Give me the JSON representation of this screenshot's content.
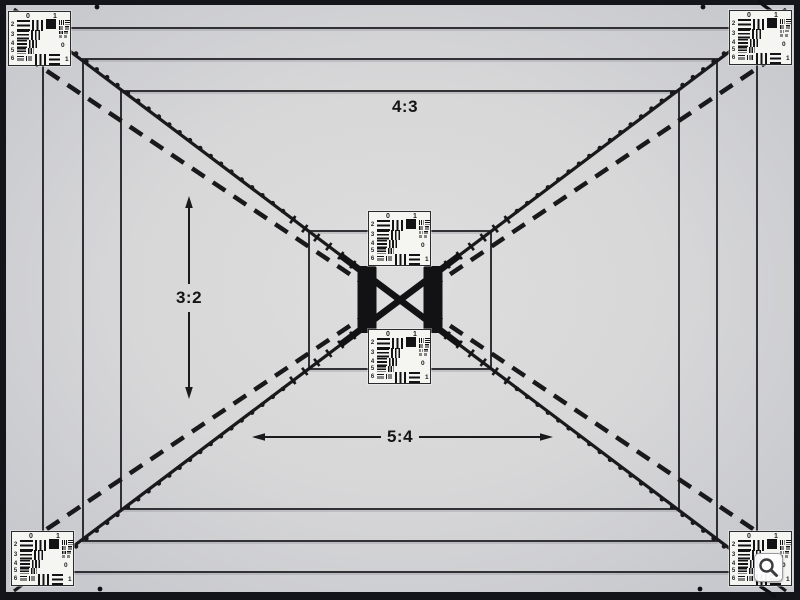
{
  "page": {
    "title": "Viewfinder accuracy test chart photograph"
  },
  "labels": {
    "aspect_4_3": "4:3",
    "aspect_3_2": "3:2",
    "aspect_5_4": "5:4"
  },
  "usaf": {
    "top_digits": [
      "0",
      "1"
    ],
    "left_digits": [
      "2",
      "3",
      "4",
      "5",
      "6"
    ],
    "right_digits": [
      "0",
      "1"
    ]
  },
  "chart_elements": {
    "aspect_rectangles": [
      "outer",
      "middle",
      "inner-4:3",
      "center-box"
    ],
    "diagonal_styles": [
      "solid",
      "dashed",
      "dotted"
    ],
    "resolution_targets_count": 6
  },
  "icons": {
    "magnifier": "magnifying-glass"
  },
  "colors": {
    "background": "#d7d7d8",
    "vignette": "#c8c9ce",
    "ink": "#18181a",
    "frame": "#14141b",
    "target_background": "#f5f5f2"
  }
}
